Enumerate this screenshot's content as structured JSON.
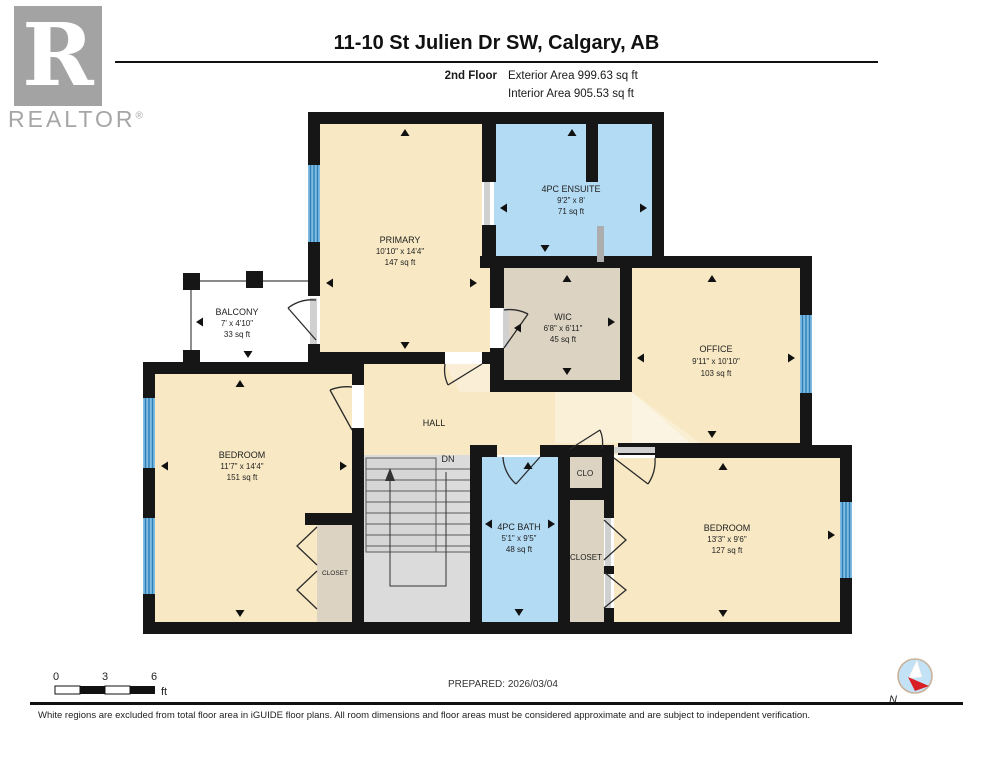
{
  "header": {
    "title": "11-10 St Julien Dr SW, Calgary, AB",
    "floor_label": "2nd Floor",
    "exterior_area": "Exterior Area 999.63 sq ft",
    "interior_area": "Interior Area 905.53 sq ft",
    "logo_letter": "R",
    "logo_word": "REALTOR",
    "logo_reg": "®"
  },
  "rooms": {
    "primary": {
      "name": "PRIMARY",
      "dims": "10'10\" x 14'4\"",
      "area": "147 sq ft"
    },
    "ensuite": {
      "name": "4PC ENSUITE",
      "dims": "9'2\" x 8'",
      "area": "71 sq ft"
    },
    "wic": {
      "name": "WIC",
      "dims": "6'8\" x 6'11\"",
      "area": "45 sq ft"
    },
    "office": {
      "name": "OFFICE",
      "dims": "9'11\" x 10'10\"",
      "area": "103 sq ft"
    },
    "balcony": {
      "name": "BALCONY",
      "dims": "7' x 4'10\"",
      "area": "33 sq ft"
    },
    "bedroom_left": {
      "name": "BEDROOM",
      "dims": "11'7\" x 14'4\"",
      "area": "151 sq ft"
    },
    "bath": {
      "name": "4PC BATH",
      "dims": "5'1\" x 9'5\"",
      "area": "48 sq ft"
    },
    "bedroom_right": {
      "name": "BEDROOM",
      "dims": "13'3\" x 9'6\"",
      "area": "127 sq ft"
    }
  },
  "labels": {
    "hall": "HALL",
    "dn": "DN",
    "clo": "CLO",
    "closet_center": "CLOSET",
    "closet_left": "CLOSET"
  },
  "scale_bar": {
    "start": "0",
    "mid": "3",
    "end": "6",
    "unit": "ft"
  },
  "footer": {
    "prepared": "PREPARED: 2026/03/04",
    "compass_label": "N",
    "disclaimer": "White regions are excluded from total floor area in iGUIDE floor plans. All room dimensions and floor areas must be considered approximate and are subject to independent verification."
  },
  "colors": {
    "room_cream": "#f8e9c4",
    "room_tan": "#dcd3c2",
    "room_blue": "#b4dbf4",
    "window_blue": "#7fbce2",
    "window_stripe": "#2f7fb6",
    "wall_black": "#161616",
    "stair_gray": "#dbdbdb"
  }
}
